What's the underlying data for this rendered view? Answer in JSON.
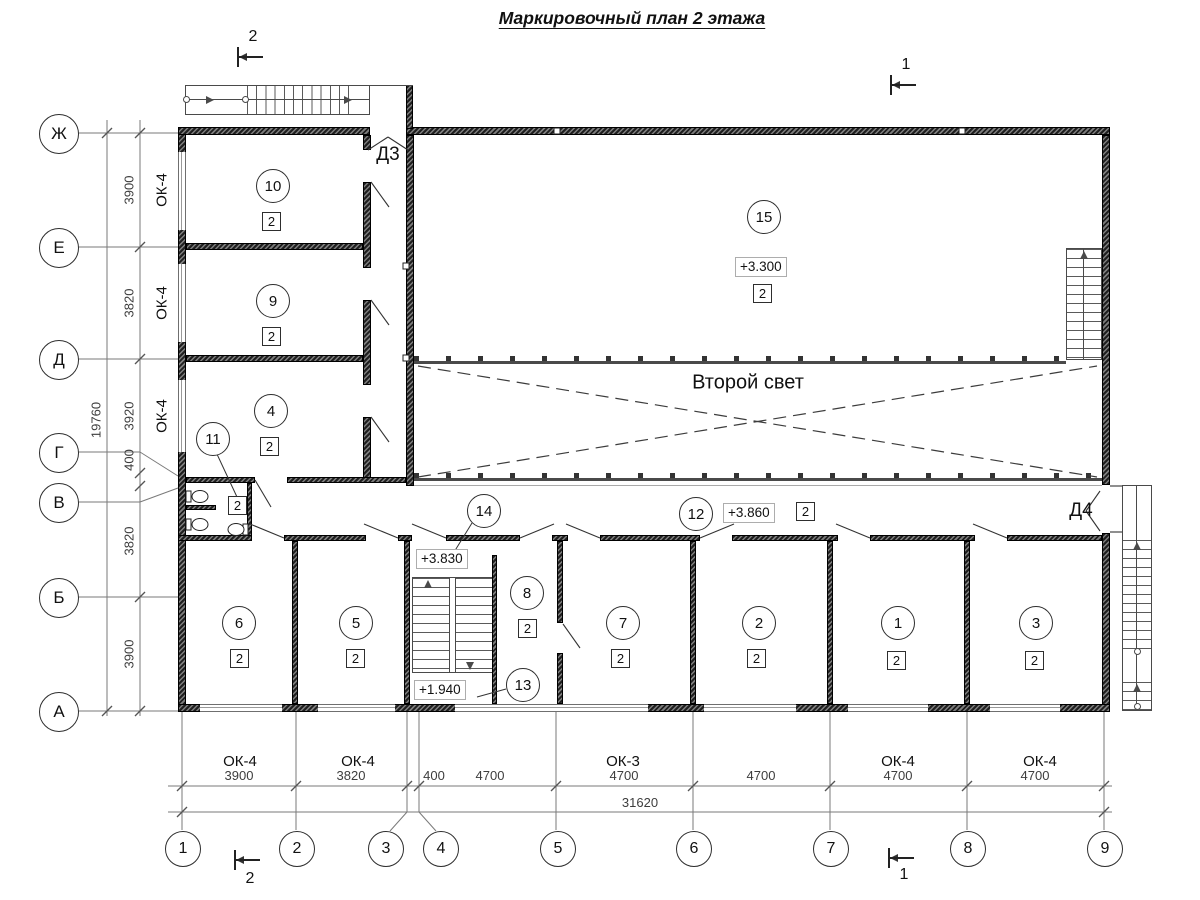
{
  "title": "Маркировочный план 2 этажа",
  "atrium": "Второй свет",
  "doors": {
    "d3": "Д3",
    "d4": "Д4"
  },
  "elevations": {
    "hall": "+3.300",
    "corridor": "+3.860",
    "landing": "+3.830",
    "half": "+1.940"
  },
  "section_marks": {
    "tl": "2",
    "tr": "1",
    "bl": "2",
    "br": "1"
  },
  "axes_bottom": [
    "1",
    "2",
    "3",
    "4",
    "5",
    "6",
    "7",
    "8",
    "9"
  ],
  "axes_left": [
    "Ж",
    "Е",
    "Д",
    "Г",
    "В",
    "Б",
    "А"
  ],
  "dims_bottom": [
    "3900",
    "3820",
    "400",
    "4700",
    "4700",
    "4700",
    "4700",
    "4700"
  ],
  "total_bottom": "31620",
  "dims_left": [
    "3900",
    "3820",
    "3920",
    "400",
    "3820",
    "3900"
  ],
  "total_left": "19760",
  "windows_bottom": [
    "ОК-4",
    "ОК-4",
    "ОК-3",
    "ОК-4",
    "ОК-4"
  ],
  "windows_left": [
    "ОК-4",
    "ОК-4",
    "ОК-4"
  ],
  "rooms": {
    "r1": {
      "num": "1",
      "cls": "2"
    },
    "r2": {
      "num": "2",
      "cls": "2"
    },
    "r3": {
      "num": "3",
      "cls": "2"
    },
    "r4": {
      "num": "4",
      "cls": "2"
    },
    "r5": {
      "num": "5",
      "cls": "2"
    },
    "r6": {
      "num": "6",
      "cls": "2"
    },
    "r7": {
      "num": "7",
      "cls": "2"
    },
    "r8": {
      "num": "8",
      "cls": "2"
    },
    "r9": {
      "num": "9",
      "cls": "2"
    },
    "r10": {
      "num": "10",
      "cls": "2"
    },
    "r11": {
      "num": "11",
      "cls": "2"
    },
    "r12": {
      "num": "12",
      "cls": "2"
    },
    "r13": {
      "num": "13"
    },
    "r14": {
      "num": "14"
    },
    "r15": {
      "num": "15",
      "cls": "2"
    }
  }
}
